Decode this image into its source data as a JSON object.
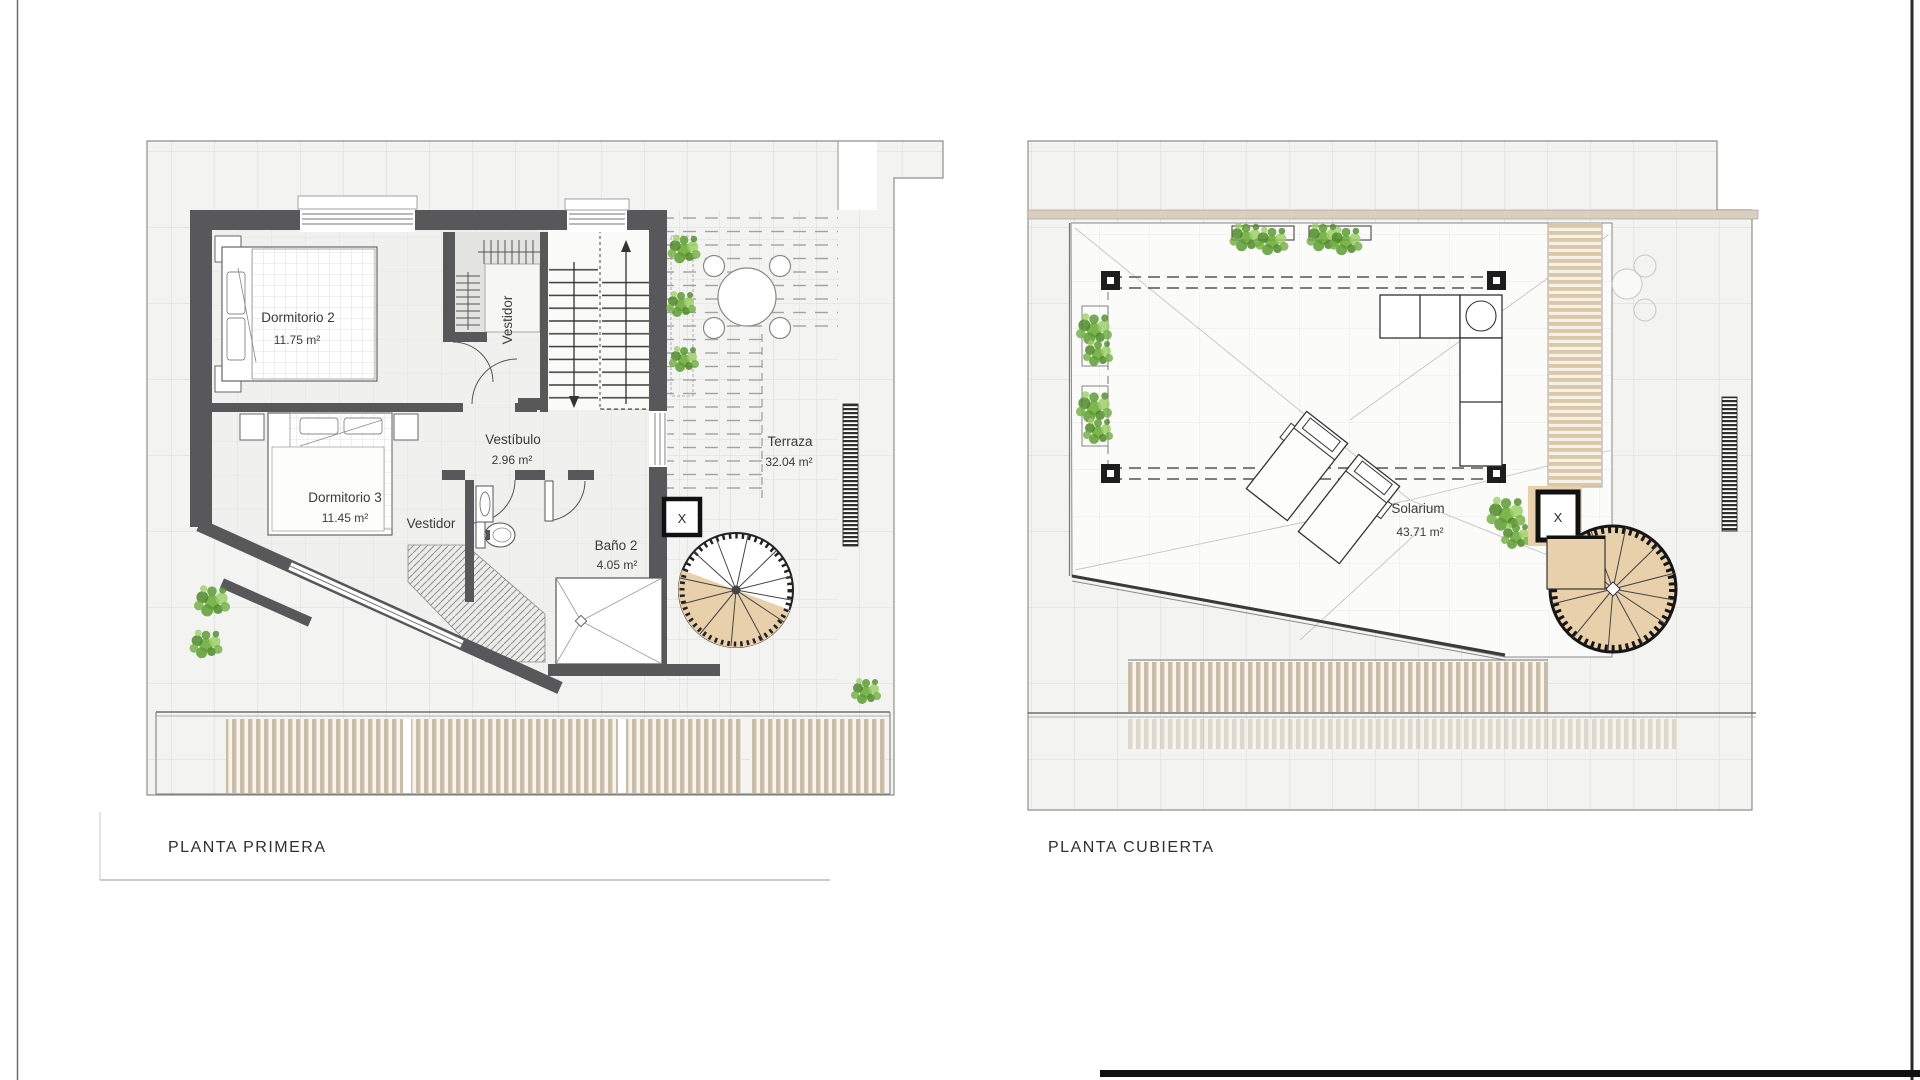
{
  "plans": {
    "left": {
      "title": "PLANTA PRIMERA",
      "labels": {
        "dormitorio2": {
          "name": "Dormitorio 2",
          "area": "11.75 m²"
        },
        "dormitorio3": {
          "name": "Dormitorio 3",
          "area": "11.45 m²"
        },
        "vestidor_norte": {
          "name": "Vestidor"
        },
        "vestibulo": {
          "name": "Vestíbulo",
          "area": "2.96 m²"
        },
        "vestidor_sur": {
          "name": "Vestidor"
        },
        "bano2": {
          "name": "Baño 2",
          "area": "4.05 m²"
        },
        "terraza": {
          "name": "Terraza",
          "area": "32.04 m²"
        },
        "elevator": "X"
      }
    },
    "right": {
      "title": "PLANTA CUBIERTA",
      "labels": {
        "solarium": {
          "name": "Solarium",
          "area": "43.71 m²"
        },
        "elevator": "X"
      }
    }
  },
  "colors": {
    "wall": "#58585a",
    "wall_dark": "#1a1a1a",
    "wood_tread": "#e8d0ab",
    "slat_tan": "#c9bda8",
    "plant_green": "#6fae3e",
    "grid_line": "#d9d9d7",
    "text": "#3b3b3b"
  }
}
